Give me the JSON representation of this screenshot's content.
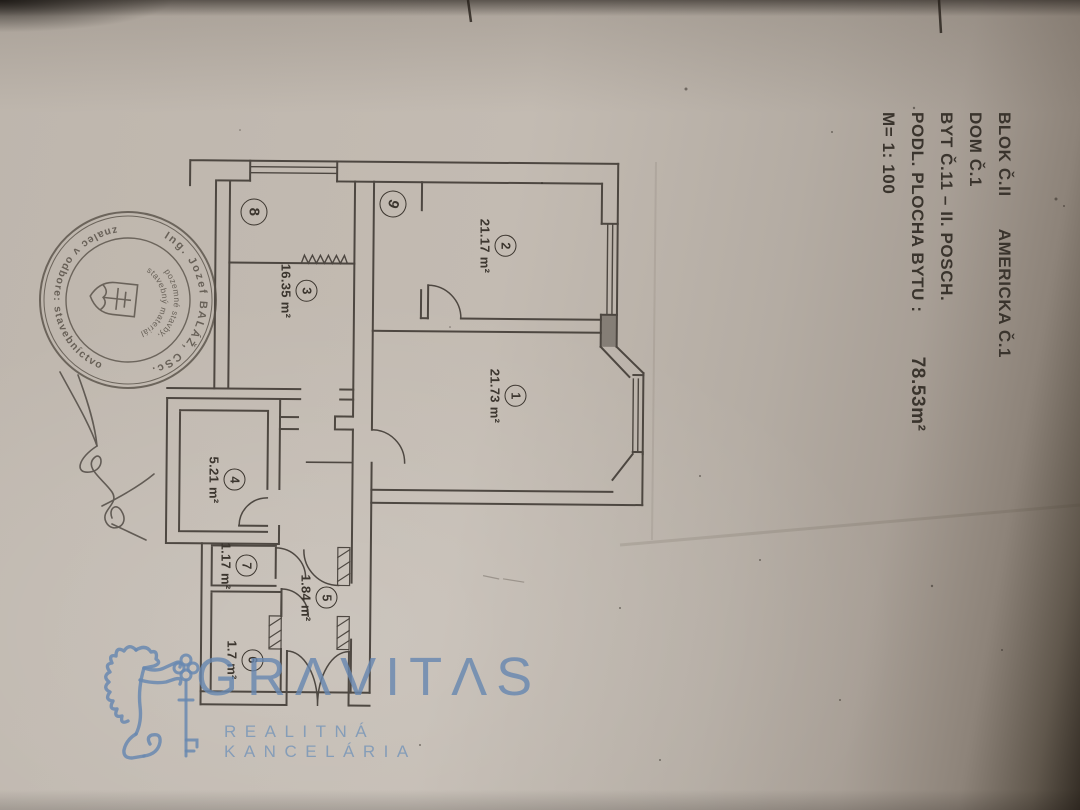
{
  "document": {
    "header": {
      "line1_left": "BLOK Č.II",
      "line1_right": "AMERICKA Č.1",
      "line2": "DOM Č.1",
      "line3": "BYT Č.11 – II. POSCH.",
      "line4_label": "PODL. PLOCHA BYTU :",
      "line4_value": "78.53m²",
      "line5_scale": "M= 1: 100"
    },
    "rooms": [
      {
        "number": "1",
        "area": "21.73 m²"
      },
      {
        "number": "2",
        "area": "21.17 m²"
      },
      {
        "number": "3",
        "area": "16.35 m²"
      },
      {
        "number": "4",
        "area": "5.21 m²"
      },
      {
        "number": "5",
        "area": "1.84 m²"
      },
      {
        "number": "6",
        "area": "1.7 m²"
      },
      {
        "number": "7",
        "area": "1.17 m²"
      },
      {
        "number": "8",
        "area": ""
      },
      {
        "number": "9",
        "area": ""
      }
    ],
    "stamp": {
      "ring_top": "Ing. Jozef BALÁŽ, CSc.",
      "ring_bottom": "znalec v odbore: stavebníctvo",
      "inner_line1": "pozemné stavby,",
      "inner_line2": "stavebný materiál"
    }
  },
  "watermark": {
    "wordmark": "GRAVITAS",
    "wordmark_display": "GRΛVITΛS",
    "subtitle": "REALITNÁ KANCELÁRIA",
    "color": "#7d9cc2"
  }
}
